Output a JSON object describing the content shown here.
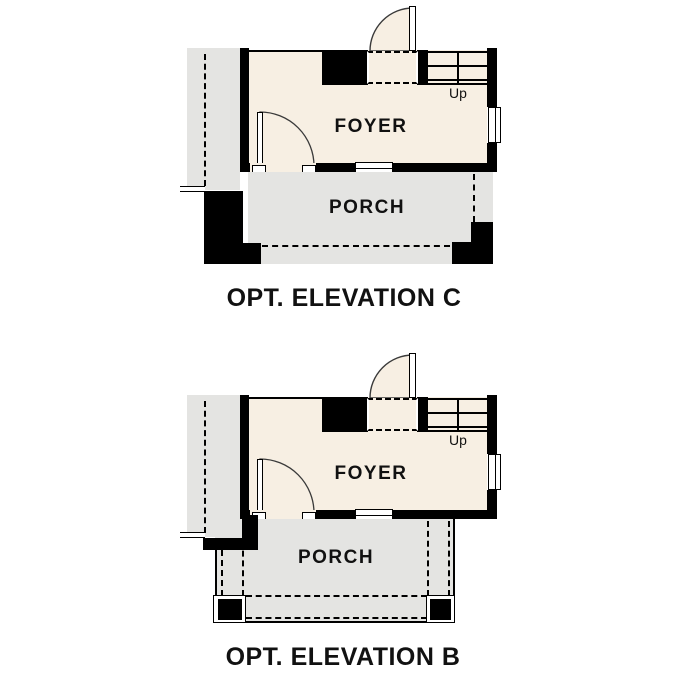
{
  "meta": {
    "drawing_type": "floor-plan-elevation-options",
    "background": "#ffffff"
  },
  "colors": {
    "wall": "#000000",
    "interior_floor": "#f7efe3",
    "porch_floor": "#e4e4e2",
    "text": "#111111"
  },
  "plans": [
    {
      "id": "opt-elevation-c",
      "title": "OPT. ELEVATION C",
      "rooms": {
        "foyer": "FOYER",
        "porch": "PORCH"
      },
      "stair_label": "Up"
    },
    {
      "id": "opt-elevation-b",
      "title": "OPT. ELEVATION B",
      "rooms": {
        "foyer": "FOYER",
        "porch": "PORCH"
      },
      "stair_label": "Up"
    }
  ]
}
